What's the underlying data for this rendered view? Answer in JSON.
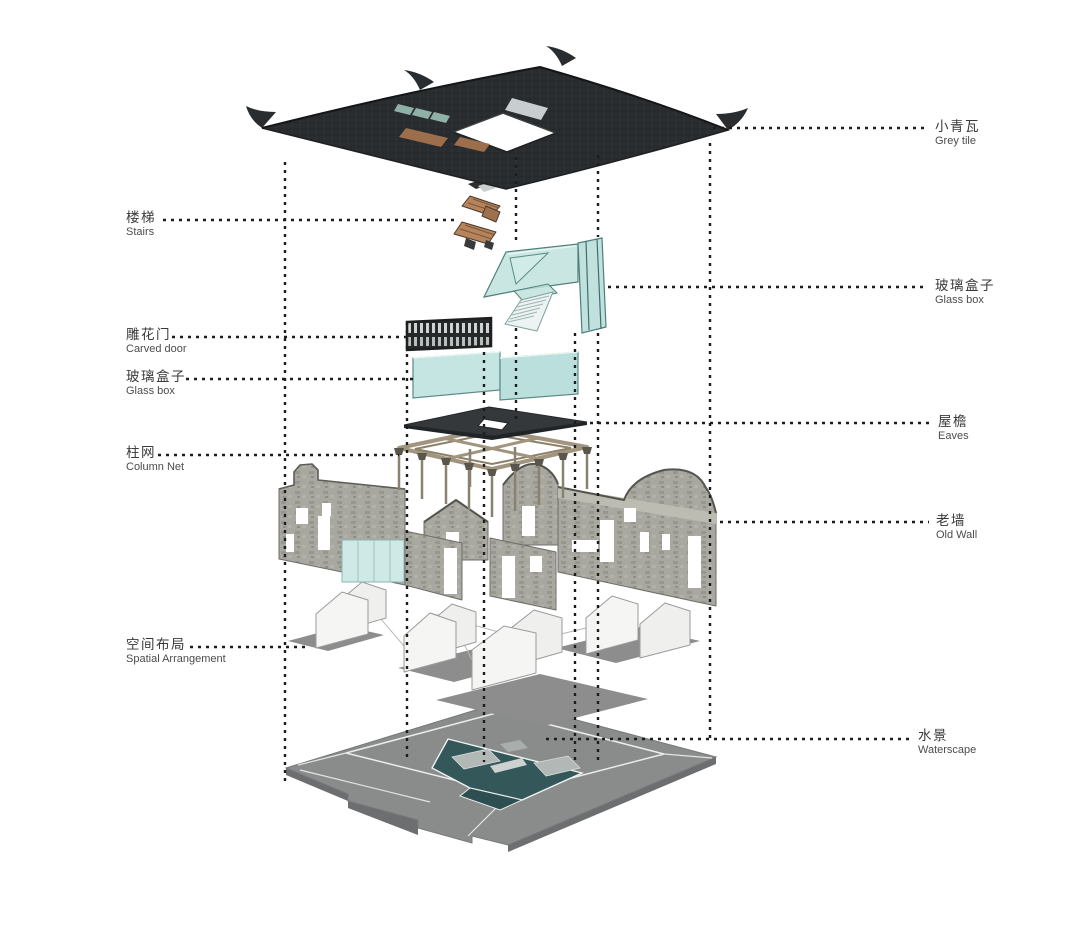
{
  "labels": {
    "left": [
      {
        "cn": "楼梯",
        "en": "Stairs"
      },
      {
        "cn": "雕花门",
        "en": "Carved door"
      },
      {
        "cn": "玻璃盒子",
        "en": "Glass box"
      },
      {
        "cn": "柱网",
        "en": "Column Net"
      },
      {
        "cn": "空间布局",
        "en": "Spatial Arrangement"
      }
    ],
    "right": [
      {
        "cn": "小青瓦",
        "en": "Grey tile"
      },
      {
        "cn": "玻璃盒子",
        "en": "Glass box"
      },
      {
        "cn": "屋檐",
        "en": "Eaves"
      },
      {
        "cn": "老墙",
        "en": "Old Wall"
      },
      {
        "cn": "水景",
        "en": "Waterscape"
      }
    ]
  },
  "components": [
    "grey-tile-roof",
    "stairs",
    "glass-box-upper",
    "carved-door",
    "glass-box-lower",
    "eaves",
    "column-net",
    "old-wall",
    "spatial-arrangement",
    "waterscape"
  ],
  "palette": {
    "background": "#ffffff",
    "roof_dark": "#2a2d2f",
    "glass_teal": "#bfe2de",
    "stair_wood": "#b5835c",
    "stone_wall": "#a8a7a0",
    "floor_grey": "#8a8c8c",
    "pond_teal": "#34575a",
    "leader_line": "#1c1c1c"
  }
}
